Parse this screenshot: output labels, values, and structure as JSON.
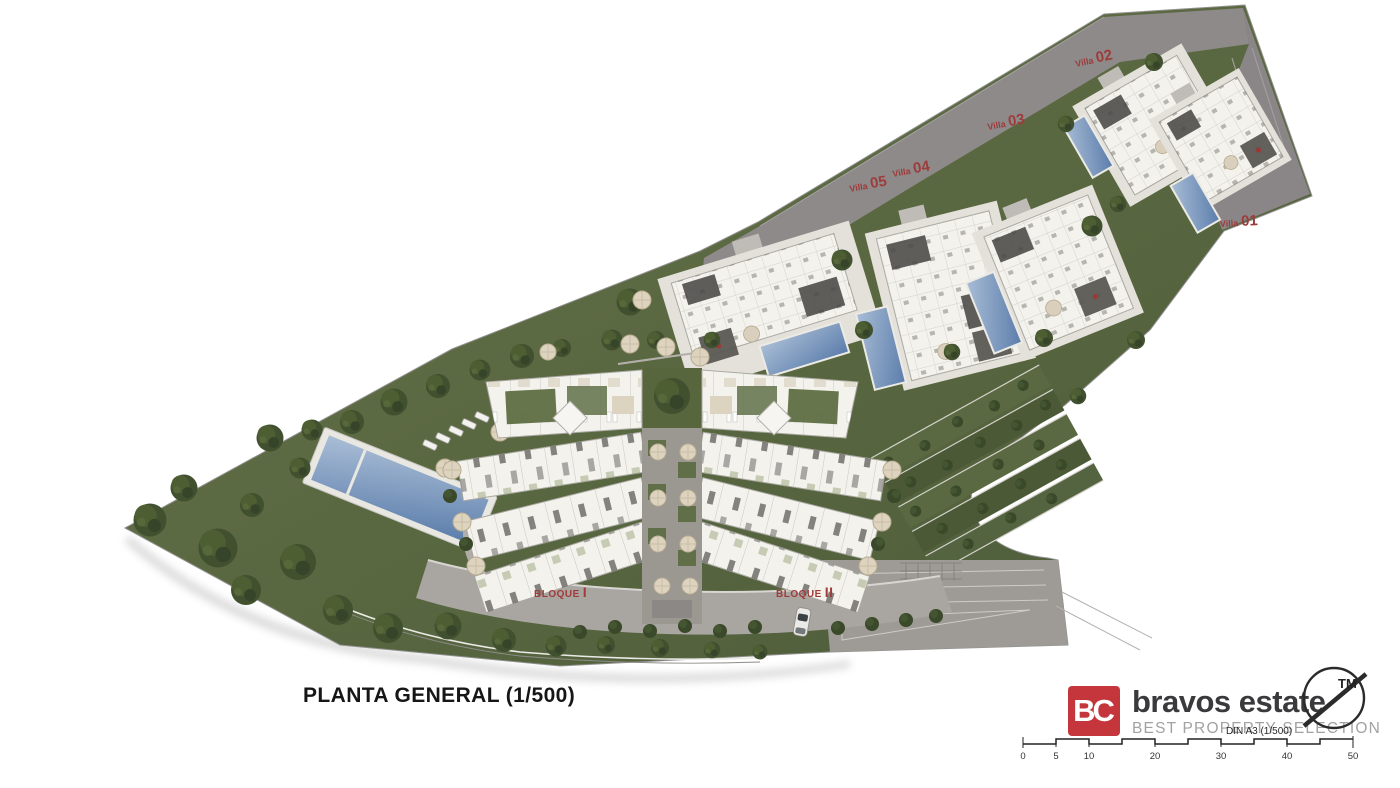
{
  "page": {
    "title": "PLANTA GENERAL (1/500)"
  },
  "villas": [
    {
      "name": "Villa",
      "number": "01"
    },
    {
      "name": "Villa",
      "number": "02"
    },
    {
      "name": "Villa",
      "number": "03"
    },
    {
      "name": "Villa",
      "number": "04"
    },
    {
      "name": "Villa",
      "number": "05"
    }
  ],
  "blocks": [
    {
      "name": "BLOQUE",
      "number": "I"
    },
    {
      "name": "BLOQUE",
      "number": "II"
    }
  ],
  "branding": {
    "initials": "BC",
    "name": "bravos estate",
    "tagline": "BEST PROPERTY SELECTION",
    "trademark": "TM"
  },
  "scale_bar": {
    "sheet_note": "DIN A3 (1/500)",
    "ticks": [
      "0",
      "5",
      "10",
      "20",
      "30",
      "40",
      "50"
    ]
  },
  "colors": {
    "brand_red": "#c5363c",
    "label_red": "#9e3b3b",
    "pool_blue": "#5b7dab",
    "garden_green": "#55643d",
    "road_gray": "#8e8a89"
  }
}
